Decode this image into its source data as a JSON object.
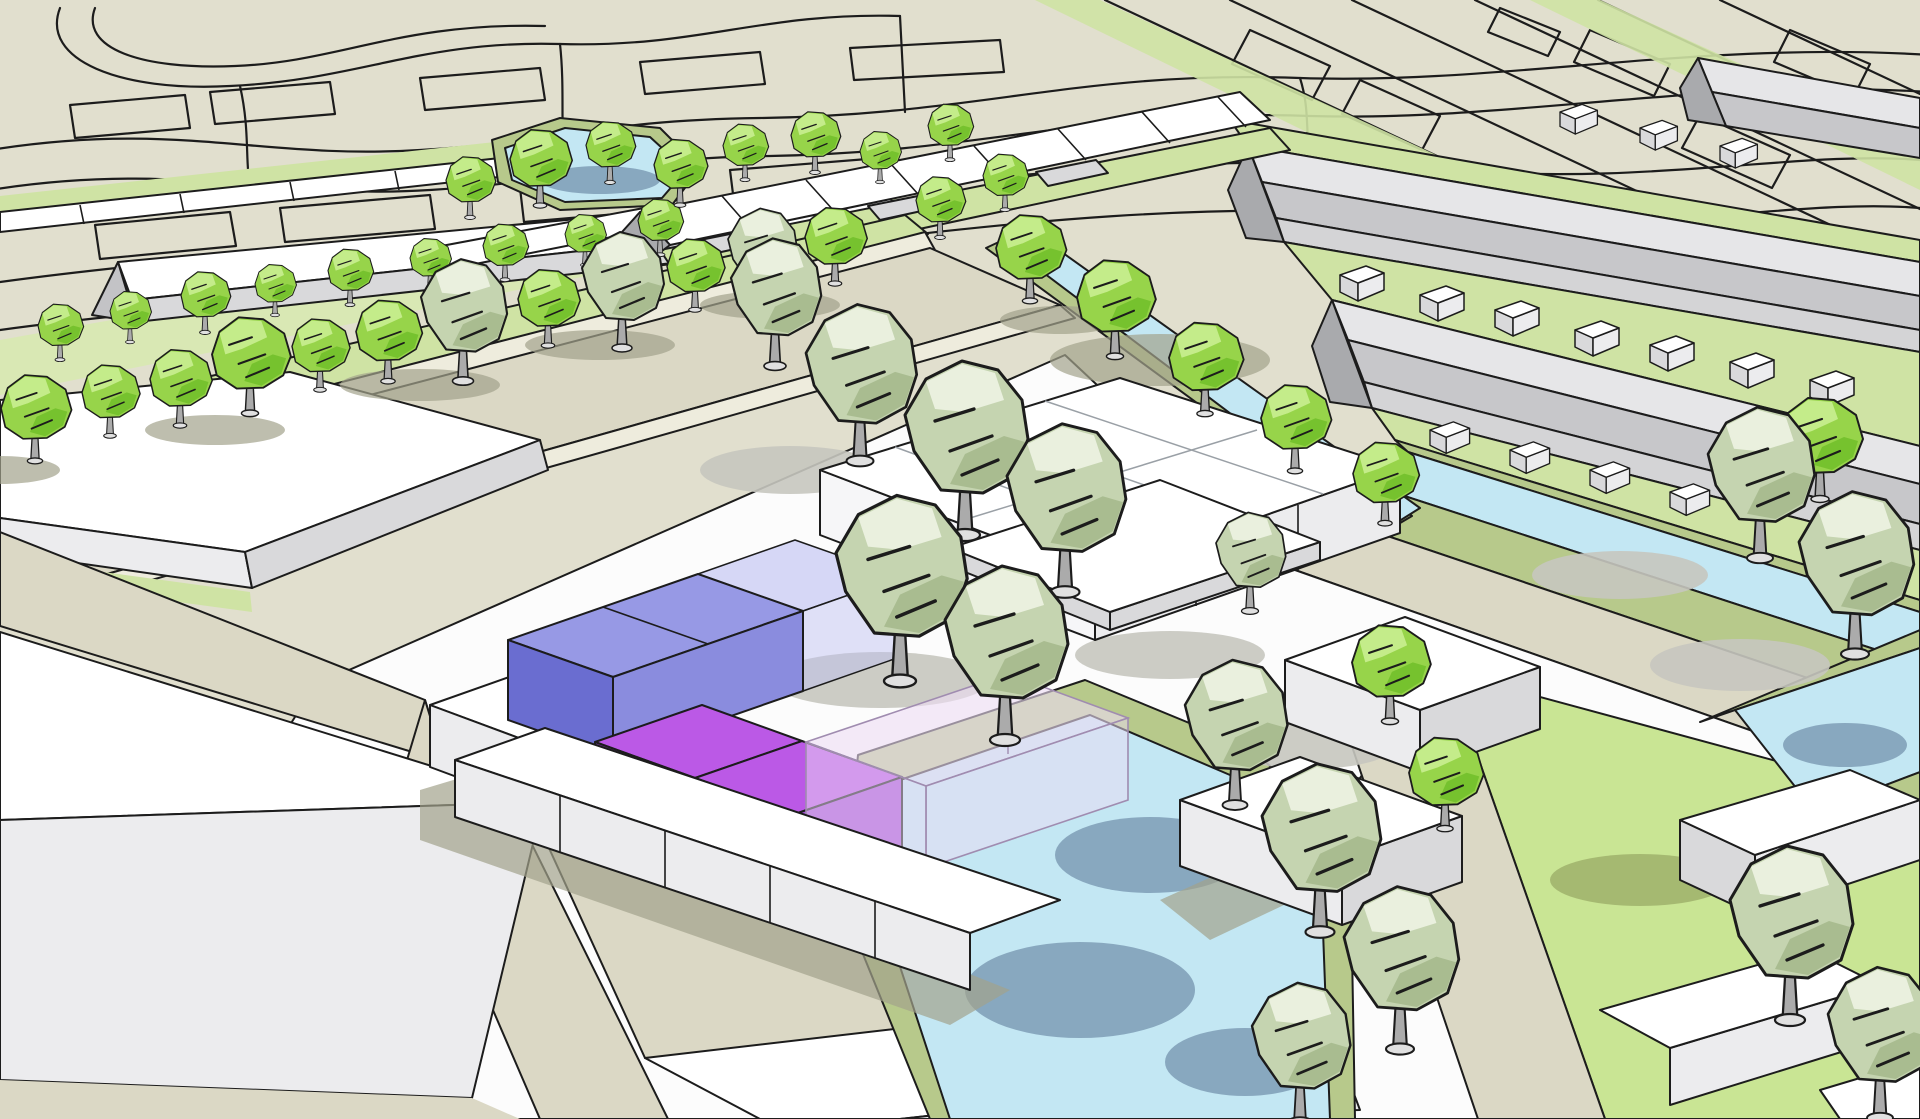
{
  "scene": {
    "type": "3d-urban-massing-render",
    "description_elements": [
      "flat-2d-map-background",
      "tree-lined-street",
      "white-massing-slab-buildings",
      "row-house-terraces",
      "central-voxel-building",
      "highlighted-blue-blocks",
      "highlighted-purple-blocks",
      "translucent-ghost-blocks",
      "canals-and-pond",
      "lawn-with-outbuildings"
    ],
    "highlights": {
      "blue_opaque_blocks": 2,
      "blue_ghost_blocks": 1,
      "purple_opaque_blocks": 2,
      "pink_ghost_blocks": 1
    }
  },
  "palette": {
    "map_bg": "#e1dfce",
    "map_line": "#1c1c1c",
    "outline": "#1c1c1c",
    "road": "#dbd8c5",
    "sidewalk": "#eeecdd",
    "verge": "#cfe3a4",
    "garden": "#d9e8b4",
    "lawn": "#c9e594",
    "bank": "#b7c98b",
    "water": "#c3e7f3",
    "water_shadow": "#7e9cb5",
    "plaza": "#fcfcfc",
    "white_top": "#ffffff",
    "face_light": "#ececee",
    "face_mid": "#d9d9db",
    "face_dark": "#c3c3c6",
    "gable": "#a9aaad",
    "bar_lit": "#e6e6e8",
    "bar_shade": "#c7c7ca",
    "bar_face": "#d4d4d6",
    "trunk": "#ababab",
    "shadow_olive": "#a3a38c",
    "shadow_grey": "#c6c6bf",
    "shadow_green": "#9fb26b",
    "tree_bright_dark": "#76c22e",
    "tree_bright_mid": "#97d44a",
    "tree_bright_light": "#c4ec8a",
    "tree_sage_dark": "#a9bc90",
    "tree_sage_mid": "#c5d4b0",
    "tree_sage_light": "#eaf0de",
    "block_blue_top": "#9799e5",
    "block_blue_left": "#6a6dd0",
    "block_blue_front": "#8a8cde",
    "block_blue_ghost": "#bcbef2",
    "block_purple_top": "#bb59e6",
    "block_purple_left": "#8d39c2",
    "block_purple_front": "#a74fd8",
    "block_pink_ghost": "#ecdcf4"
  }
}
